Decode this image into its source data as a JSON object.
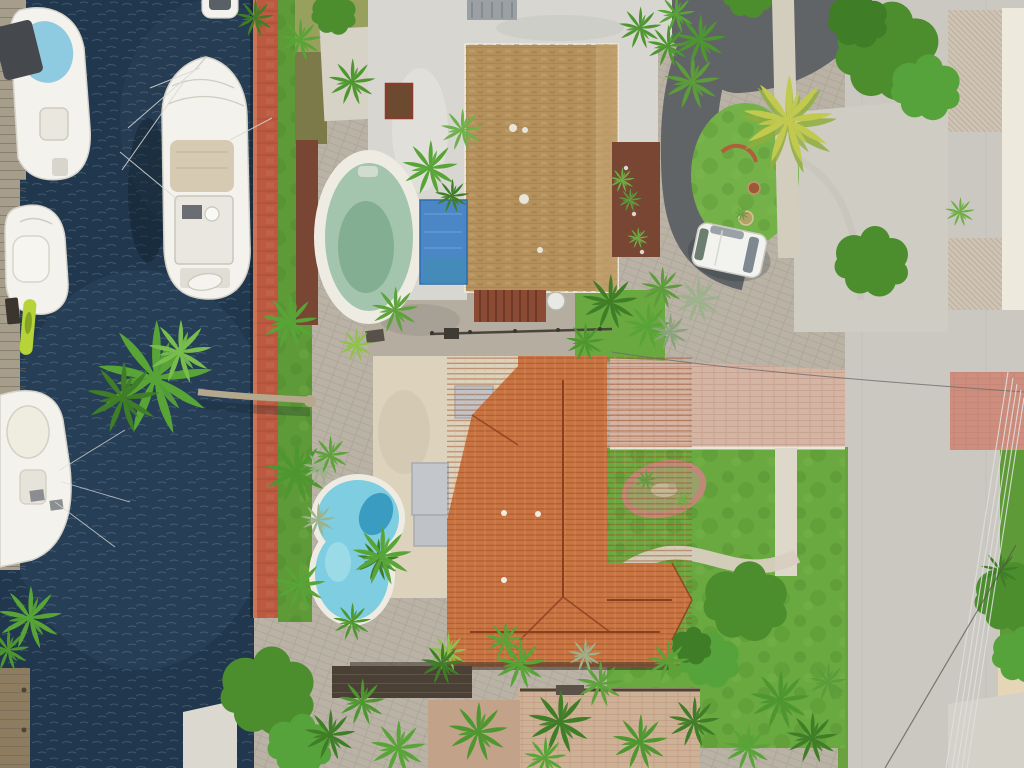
{
  "scene": {
    "title": "Aerial drone view of waterfront homes: canal with docked boats, red brick seawall, two houses with pools, tropical palms and a street with power lines",
    "objects": {
      "boats_in_canal": 4,
      "small_boat_at_top_edge": 1,
      "kayak": 1,
      "pools": 2,
      "houses": 2,
      "parked_van": 1,
      "pergola": 1,
      "satellite_dish": 1
    },
    "palette": {
      "water": "#21374d",
      "water_light": "#2d4a63",
      "ripple": "#a9c3d6",
      "seawall": "#bc5a41",
      "dock_wood": "#a79d8b",
      "pier_wood": "#8d7c60",
      "concrete_dock": "#dbd8cf",
      "boat_white": "#f3f2ec",
      "boat_canvas": "#d6cab2",
      "tarp_gray": "#45494d",
      "bow_cover": "#8ecbe0",
      "kayak": "#b6d438",
      "grass": "#5e9a37",
      "lawn": "#6aa840",
      "island_grass": "#74b148",
      "palm_green": "#58a437",
      "palm_dark": "#3f7d27",
      "palm_yellow": "#c2c94f",
      "palm_silver": "#9db28c",
      "tree_green": "#4c8e2e",
      "mulch": "#7a4634",
      "moss": "#98a05e",
      "paver": "#b9b2a5",
      "pool_deck": "#eeece2",
      "pool_green": "#a3c5ad",
      "pool_green_deep": "#7fa98c",
      "pool_blue": "#7ecde0",
      "pool_blue_deep": "#3a9cc0",
      "tarp_blue": "#4b86c6",
      "white_roof": "#d7d6d0",
      "roof_hatch": "#9aa0a4",
      "shingle_roof": "#b3905c",
      "cream_roof": "#ddd3bd",
      "skylight": "#c0c3c7",
      "tile_roof": "#c97443",
      "tile_ridge": "#8a3f1f",
      "pergola": "#8a4a34",
      "concrete": "#cfccc4",
      "road": "#cac8c1",
      "asphalt": "#616467",
      "curb": "#eee9dd",
      "sidewalk_tan": "#e5d6b8",
      "pink_driveway": "#d4b4a3",
      "pink_band": "#cf8d7d",
      "van": "#f2f3ef",
      "van_glass": "#7e8890",
      "wire": "#e0e0e0",
      "wire_dark": "#5f5c55",
      "shadow": "#0f1c28"
    }
  }
}
